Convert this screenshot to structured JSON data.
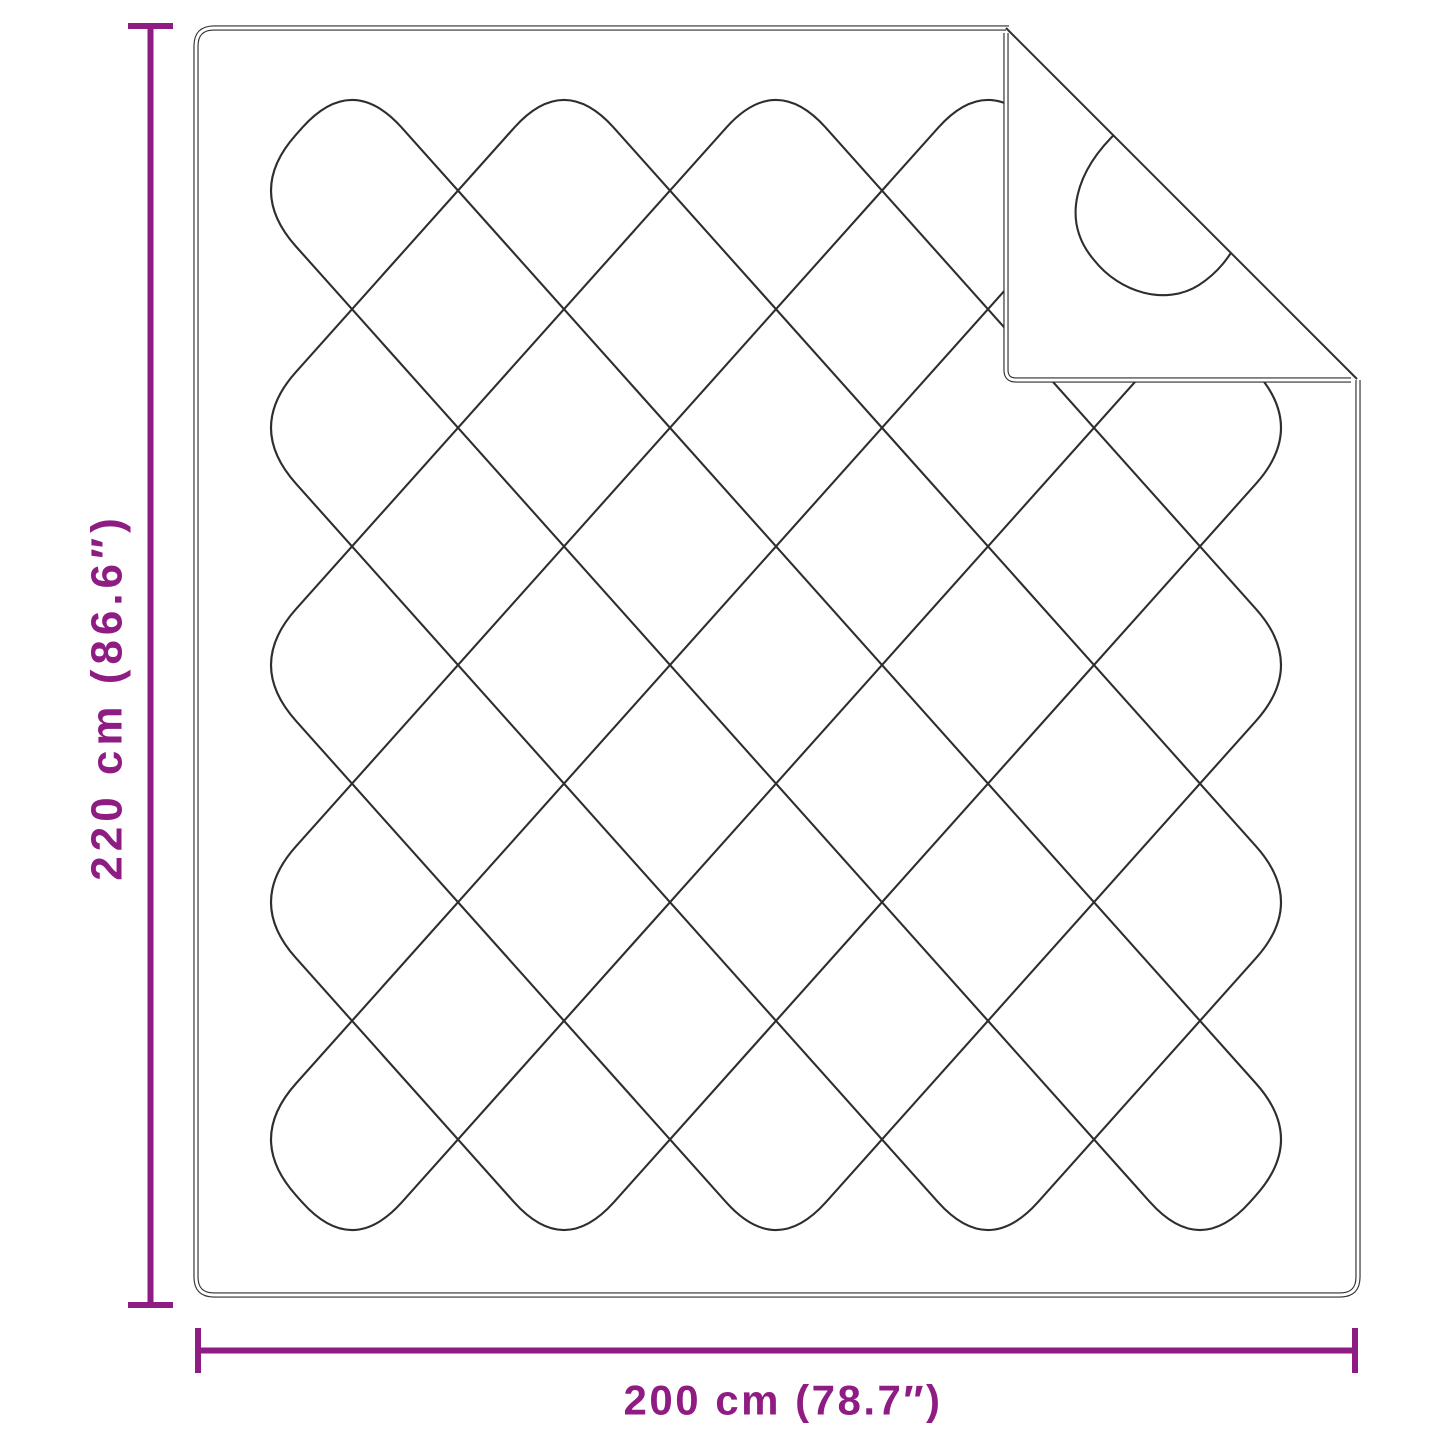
{
  "diagram": {
    "product": "quilted-blanket-with-folded-corner",
    "dimensions": {
      "height": {
        "label": "220 cm (86.6″)",
        "value_cm": 220,
        "value_inch": 86.6
      },
      "width": {
        "label": "200 cm (78.7″)",
        "value_cm": 200,
        "value_inch": 78.7
      }
    },
    "colors": {
      "dimension_accent": "#8f1c82",
      "outline": "#2e2e2e",
      "background": "#ffffff"
    }
  }
}
